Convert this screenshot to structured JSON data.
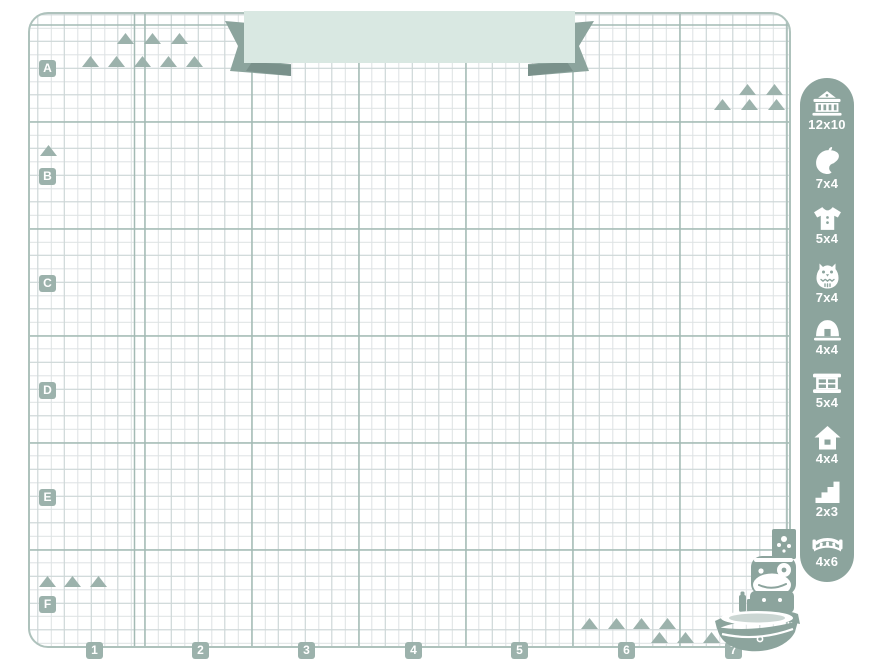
{
  "colors": {
    "sage": "#8ca49d",
    "sage_dark": "#7a918b",
    "marker_sage": "#9cb2ac",
    "mint_banner": "#d9e8e2",
    "grid_major": "#a3bab4",
    "grid_mid": "#ccd6d6",
    "grid_minor": "#dde2e3",
    "sheet_border": "#aec2bc"
  },
  "banner": {
    "text": ""
  },
  "grid": {
    "row_labels": [
      "A",
      "B",
      "C",
      "D",
      "E",
      "F"
    ],
    "column_labels": [
      "1",
      "2",
      "3",
      "4",
      "5",
      "6",
      "7"
    ]
  },
  "sidebar": {
    "items": [
      {
        "icon": "town-hall-icon",
        "size_label": "12x10"
      },
      {
        "icon": "leaf-icon",
        "size_label": "7x4"
      },
      {
        "icon": "shirt-icon",
        "size_label": "5x4"
      },
      {
        "icon": "owl-icon",
        "size_label": "7x4"
      },
      {
        "icon": "tent-icon",
        "size_label": "4x4"
      },
      {
        "icon": "shop-window-icon",
        "size_label": "5x4"
      },
      {
        "icon": "house-icon",
        "size_label": "4x4"
      },
      {
        "icon": "stairs-icon",
        "size_label": "2x3"
      },
      {
        "icon": "bridge-icon",
        "size_label": "4x6"
      }
    ]
  }
}
